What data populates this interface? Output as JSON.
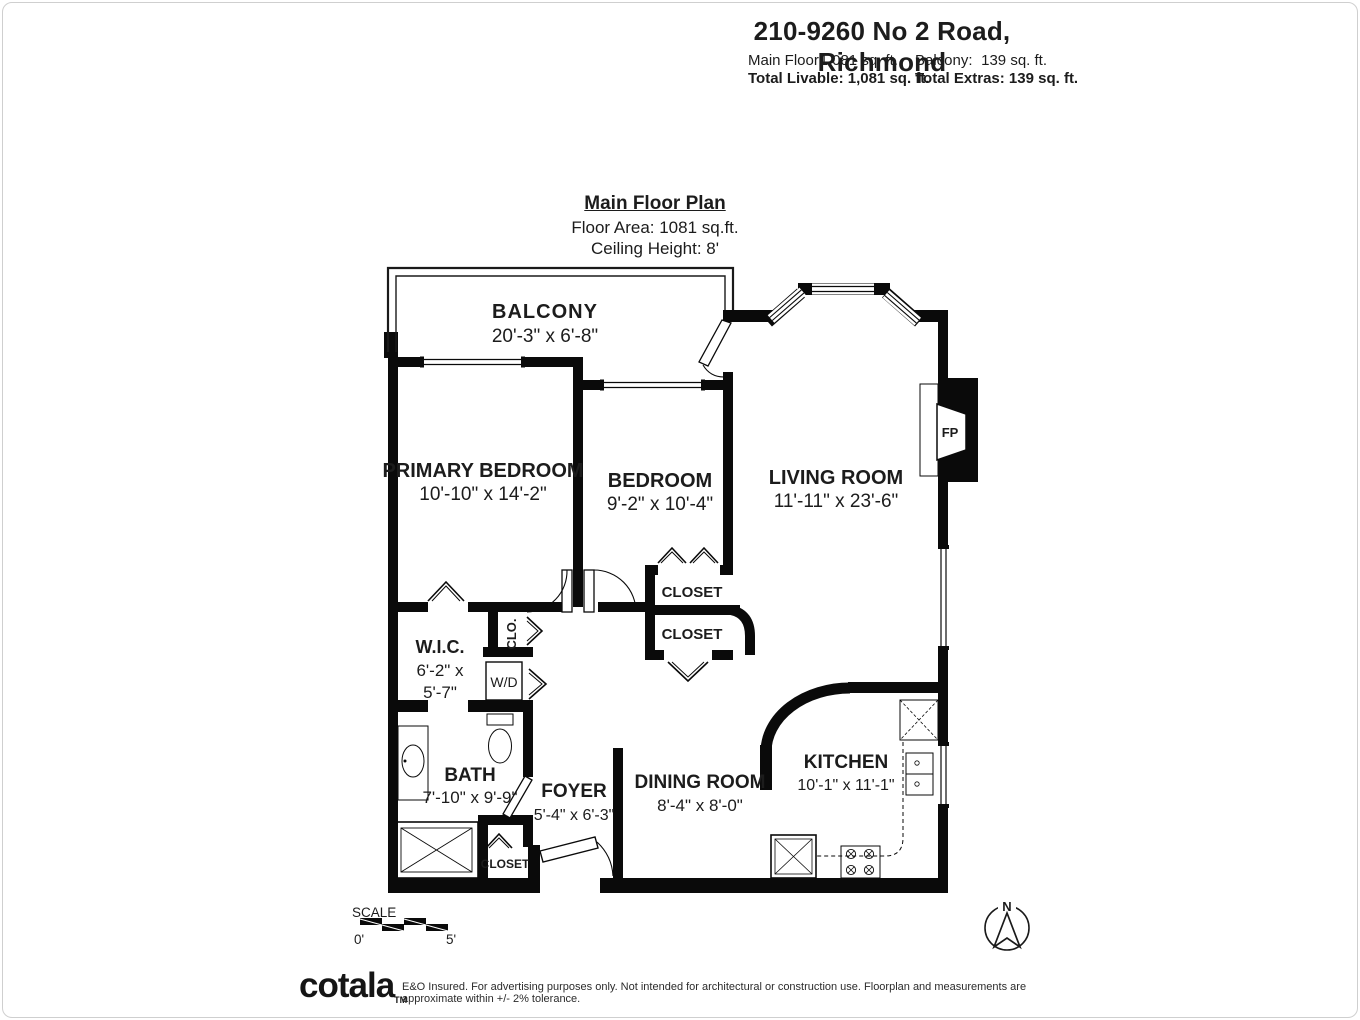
{
  "header": {
    "address": "210-9260 No 2 Road, Richmond",
    "main_floor_label": "Main Floor:",
    "main_floor_value": "1,081 sq. ft.",
    "balcony_label": "Balcony:",
    "balcony_value": "139 sq. ft.",
    "total_livable": "Total Livable: 1,081 sq. ft.",
    "total_extras": "Total Extras: 139 sq. ft."
  },
  "plan_title": {
    "title": "Main Floor Plan",
    "floor_area": "Floor Area: 1081 sq.ft.",
    "ceiling_height": "Ceiling Height: 8'"
  },
  "rooms": {
    "balcony": {
      "name": "BALCONY",
      "dims": "20'-3\" x  6'-8\""
    },
    "primary_bedroom": {
      "name": "PRIMARY BEDROOM",
      "dims": "10'-10\" x 14'-2\""
    },
    "bedroom": {
      "name": "BEDROOM",
      "dims": "9'-2\"  x 10'-4\""
    },
    "living_room": {
      "name": "LIVING ROOM",
      "dims": "11'-11\" x 23'-6\""
    },
    "wic": {
      "name": "W.I.C.",
      "dims1": "6'-2\" x",
      "dims2": "5'-7\""
    },
    "bath": {
      "name": "BATH",
      "dims": "7'-10\" x  9'-9\""
    },
    "foyer": {
      "name": "FOYER",
      "dims": "5'-4\" x 6'-3\""
    },
    "dining_room": {
      "name": "DINING ROOM",
      "dims": "8'-4\" x 8'-0\""
    },
    "kitchen": {
      "name": "KITCHEN",
      "dims": "10'-1\" x 11'-1\""
    },
    "closet_upper": "CLOSET",
    "closet_lower": "CLOSET",
    "closet_entry": "CLOSET",
    "clo": "CLO.",
    "wd": "W/D",
    "fireplace": "FP"
  },
  "scale_bar": {
    "label": "SCALE",
    "start": "0'",
    "end": "5'"
  },
  "compass": {
    "north": "N"
  },
  "footer": {
    "logo": "cotala",
    "tm": "TM",
    "disclaimer": "E&O Insured. For advertising purposes only. Not intended for architectural or construction use. Floorplan and measurements are approximate within +/- 2% tolerance."
  }
}
